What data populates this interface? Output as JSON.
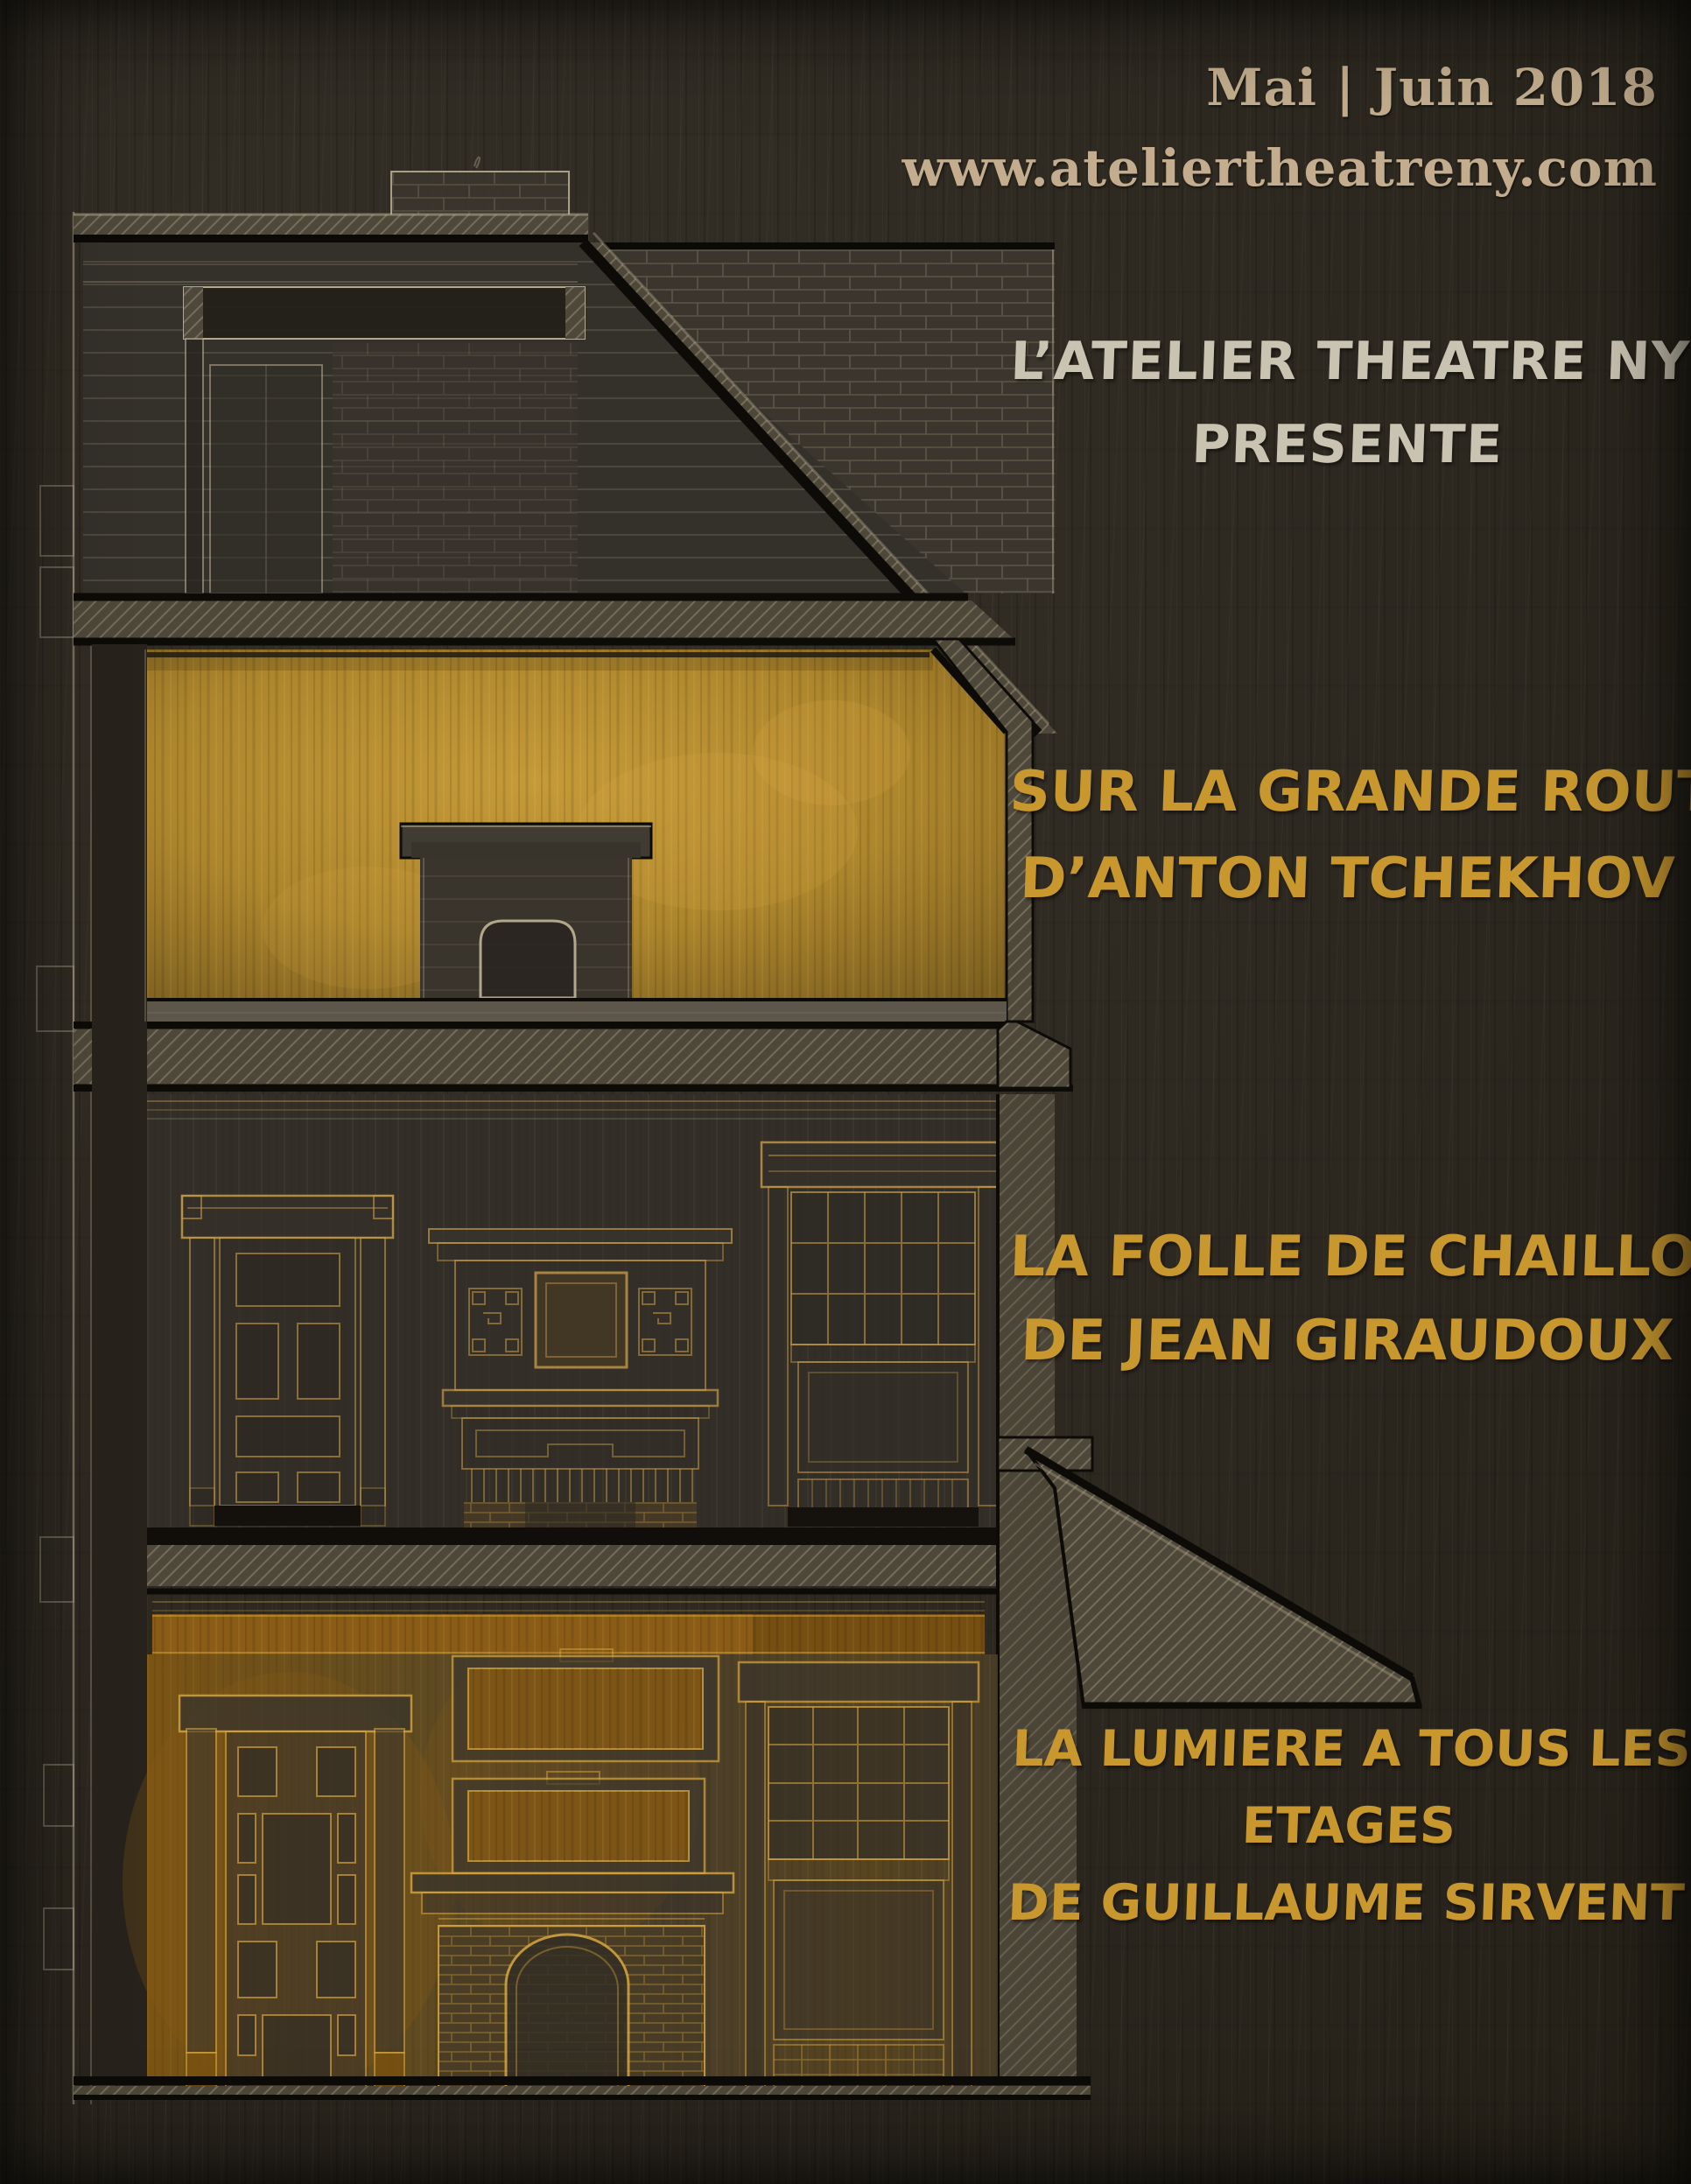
{
  "masthead": {
    "issue_date": "Mai | Juin 2018",
    "website": "www.ateliertheatreny.com"
  },
  "presenter": {
    "lines": [
      "L’ATELIER THEATRE NY",
      "PRESENTE"
    ]
  },
  "shows": [
    {
      "lines": [
        "SUR LA GRANDE ROUTE",
        "D’ANTON TCHEKHOV"
      ]
    },
    {
      "lines": [
        "LA FOLLE DE CHAILLOT",
        "DE JEAN GIRAUDOUX"
      ]
    },
    {
      "lines": [
        "LA LUMIERE A TOUS LES",
        "ETAGES",
        "DE GUILLAUME SIRVENT"
      ]
    }
  ],
  "colors": {
    "background": "#2c2820",
    "masthead_text": "#c3ad8e",
    "presenter_text": "#c9c3b2",
    "show_title_text": "#c8982f",
    "second_floor_glow": "#c0912f",
    "ground_floor_glow": "#8a5c16",
    "linework": "#cfc4aa"
  }
}
